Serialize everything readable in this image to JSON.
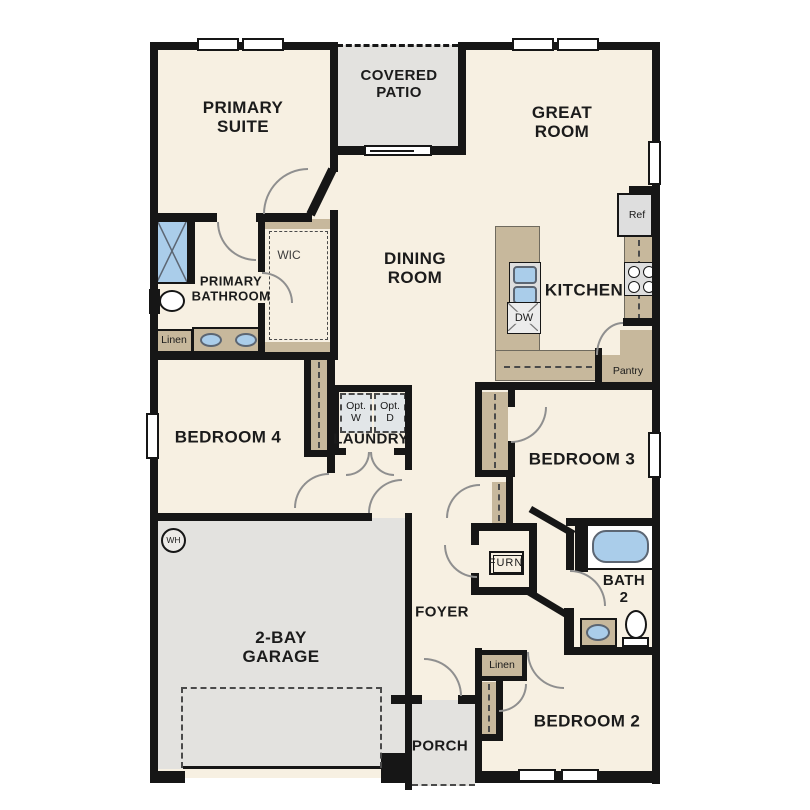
{
  "rooms": {
    "primary_suite": "PRIMARY SUITE",
    "covered_patio": "COVERED PATIO",
    "great_room": "GREAT ROOM",
    "primary_bathroom": "PRIMARY BATHROOM",
    "wic": "WIC",
    "dining_room": "DINING ROOM",
    "kitchen": "KITCHEN",
    "bedroom_4": "BEDROOM 4",
    "laundry": "LAUNDRY",
    "bedroom_3": "BEDROOM 3",
    "foyer": "FOYER",
    "bath_2": "BATH 2",
    "bedroom_2": "BEDROOM 2",
    "garage": "2-BAY GARAGE",
    "porch": "PORCH"
  },
  "fixtures": {
    "refrigerator": "Ref",
    "dishwasher": "DW",
    "optional_washer": "Opt. W",
    "optional_dryer": "Opt. D",
    "pantry": "Pantry",
    "linen_primary": "Linen",
    "linen_hall": "Linen",
    "furnace": "FURN",
    "water_heater": "WH"
  },
  "colors": {
    "floor": "#f7f0e2",
    "outdoor": "#e3e2df",
    "cabinet": "#c7b89c",
    "plumbing": "#aacdea",
    "appliance": "#dedede",
    "wall": "#161616"
  }
}
